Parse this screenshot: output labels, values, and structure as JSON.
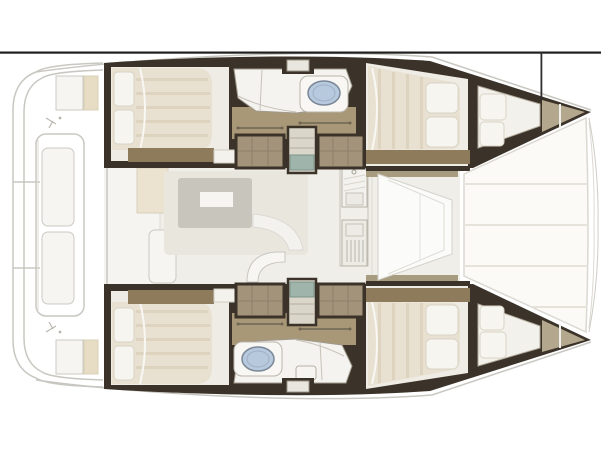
{
  "image": {
    "width": 601,
    "height": 450,
    "description": "Top-down interior floor plan drawing of a catamaran yacht (bow to the right, stern to the left), no visible text labels"
  },
  "colors": {
    "background": "#ffffff",
    "frame_line": "#1f1f1f",
    "frame_line_vertical": "#2e2e2e",
    "wall": "#3b3329",
    "floor": "#8d7b5c",
    "corridor": "#a89877",
    "wardrobe": "#a3937a",
    "bow_deck": "#b3a78d",
    "mattress": "#e8e1d1",
    "mattress_stripe": "#ddd3bf",
    "pillow": "#f7f5f0",
    "bathroom": "#f4f3ef",
    "sink": "#b7c9dd",
    "step_teal": "#9fb4aa",
    "salon_floor": "#f0eee9",
    "sofa": "#e9e6de",
    "table": "#c8c5bd",
    "deck_line": "#c9c7c1",
    "cushion": "#e7ddc5",
    "trampoline": "#fbfaf7",
    "seam": "#e6e3db"
  },
  "diagram": {
    "type": "boat-floor-plan",
    "hulls": 2,
    "cabins": 4,
    "heads": 2,
    "regions": [
      "stern-swim-platforms",
      "aft-cockpit-bench",
      "aft-cockpit",
      "salon",
      "dinette-table",
      "galley-sink-unit",
      "galley-stove-unit",
      "forward-cockpit",
      "trampoline",
      "port-aft-cabin",
      "port-head",
      "port-corridor",
      "port-companionway-steps",
      "port-forward-cabin",
      "port-forepeak",
      "port-bow",
      "starboard-aft-cabin",
      "starboard-head",
      "starboard-corridor",
      "starboard-companionway-steps",
      "starboard-forward-cabin",
      "starboard-forepeak",
      "starboard-bow"
    ]
  }
}
